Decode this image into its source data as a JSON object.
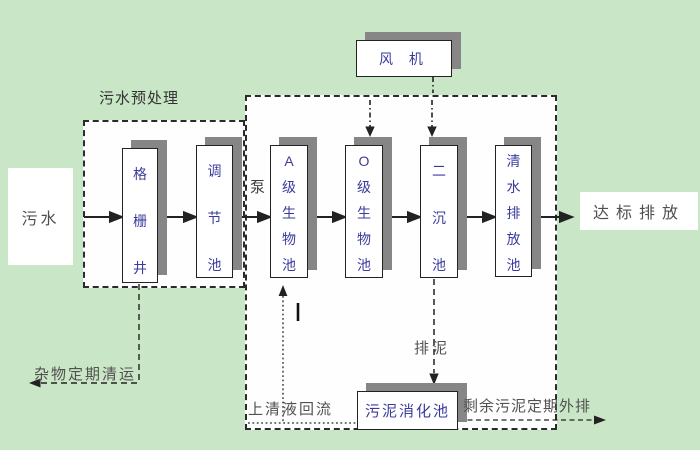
{
  "diagram": {
    "type": "wastewater-treatment-process-flowchart",
    "colors": {
      "background": "#c9e6c6",
      "region_background": "#ffffff",
      "box_shadow": "#868686",
      "line": "#222222",
      "box_text": "#3b3b9e",
      "label_text": "#515151"
    }
  },
  "boxes": {
    "sewage": "污水",
    "grid_well": "格栅井",
    "regulating_tank": "调节池",
    "a_bio_tank": "A级生物池",
    "o_bio_tank": "O级生物池",
    "secondary_sedimentation_tank": "二沉池",
    "clear_water_discharge_tank": "清水排放池",
    "blower": "风 机",
    "sludge_digestion_tank": "污泥消化池",
    "standard_discharge": "达标排放"
  },
  "labels": {
    "pretreatment_region": "污水预处理",
    "pump": "泵",
    "sludge_discharge": "排泥",
    "supernatant_return": "上清液回流",
    "excess_sludge_out": "剩余污泥定期外排",
    "debris_removal": "杂物定期清运"
  }
}
